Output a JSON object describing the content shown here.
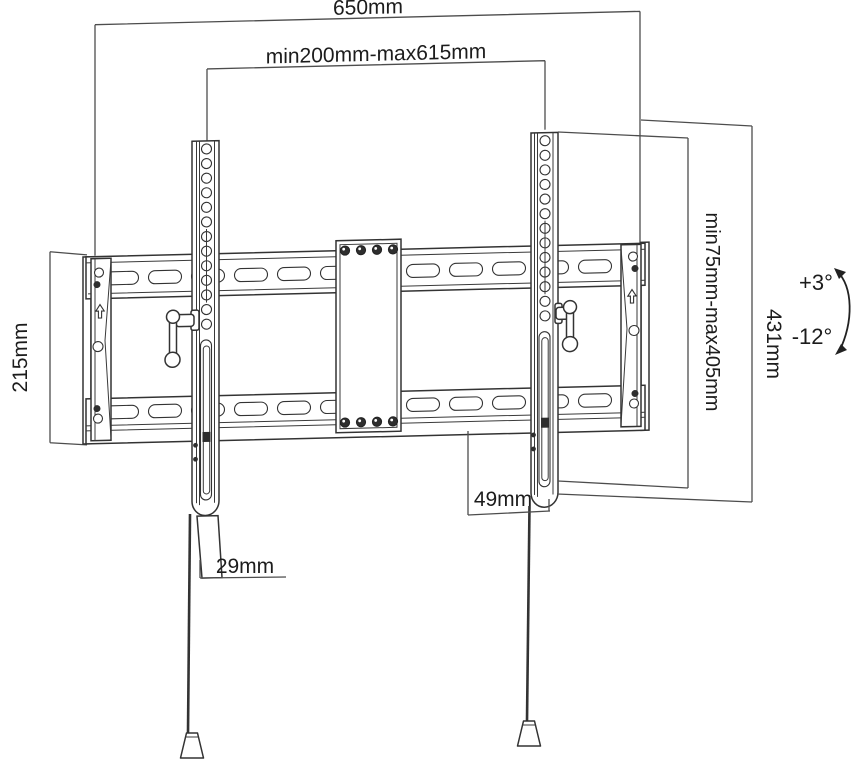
{
  "diagram": {
    "dimensions": {
      "total_width": "650mm",
      "arm_spacing": "min200mm-max615mm",
      "plate_height": "215mm",
      "vertical_range": "min75mm-max405mm",
      "arm_height": "431mm",
      "right_offset": "49mm",
      "left_offset": "29mm"
    },
    "tilt": {
      "up": "+3°",
      "down": "-12°"
    },
    "icons": {
      "end_cap_marking": "up-arrow-icon"
    },
    "colors": {
      "line": "#333333",
      "dimension_line": "#4d4d4d",
      "text": "#1c1c1c",
      "background": "#ffffff"
    }
  }
}
